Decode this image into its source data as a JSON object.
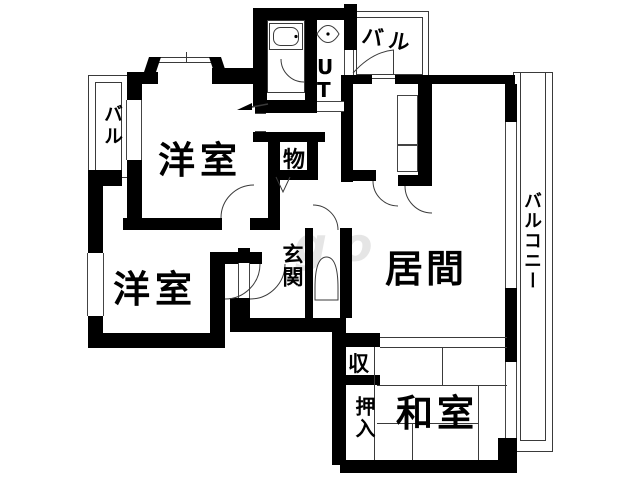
{
  "labels": {
    "room_top_left": "洋室",
    "room_bottom_left": "洋室",
    "living": "居間",
    "tatami_room": "和室",
    "entrance": "玄関",
    "utility": "UT",
    "storage_small": "物",
    "storage_shu": "収",
    "closet_oshiire": "押入",
    "balcony_left": "バル",
    "balcony_top": "バル",
    "balcony_right": "バルコニー",
    "watermark": "go"
  },
  "colors": {
    "wall": "#000000",
    "thin_line": "#3a3a3a",
    "text": "#000000",
    "background": "#ffffff"
  }
}
